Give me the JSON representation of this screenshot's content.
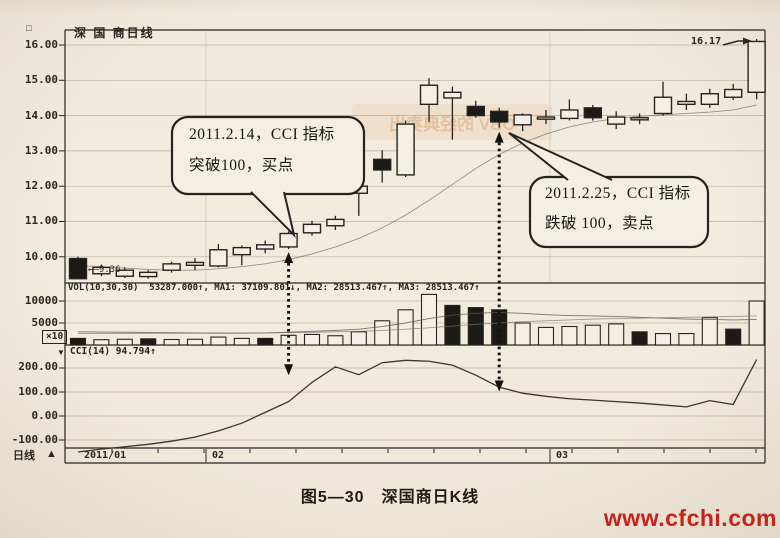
{
  "header": {
    "corner_glyph": "□",
    "title": "深 国 商日线"
  },
  "price_axis": {
    "labels": [
      "16.00",
      "15.00",
      "14.00",
      "13.00",
      "12.00",
      "11.00",
      "10.00"
    ]
  },
  "volume_axis": {
    "labels": [
      "10000",
      "5000"
    ],
    "unit": "×10"
  },
  "cci_axis": {
    "labels": [
      "200.00",
      "100.00",
      "0.00",
      "-100.00"
    ]
  },
  "indicator_labels": {
    "vol": "VOL(10,30,30)  53287.000↑, MA1: 37109.801↓, MA2: 28513.467↑, MA3: 28513.467↑",
    "cci_pointer": "▼",
    "cci": "CCI(14) 94.794↑"
  },
  "date_axis": {
    "labels": [
      "2011/01",
      "02",
      "03"
    ],
    "period": "日线",
    "marker": "▲"
  },
  "price_tags": {
    "first_low": "←–9.36",
    "last_high": "16.17"
  },
  "callouts": {
    "buy": {
      "line1": "2011.2.14，CCI 指标",
      "line2": "突破100，买点"
    },
    "sell": {
      "line1": "2011.2.25，CCI 指标",
      "line2": "跌破 100，卖点"
    }
  },
  "caption": "图5—30　深国商日K线",
  "watermark": "www.cfchi.com",
  "decor": {
    "ghost_text": "OBV 的经典卖出"
  },
  "colors": {
    "ink": "#26231f",
    "paper": "#f4efe4",
    "watermark_red": "#cf1d18"
  },
  "chart_data": {
    "type": "candlestick",
    "title": "深国商日线",
    "panels": [
      "price",
      "volume",
      "cci"
    ],
    "x_labels": [
      "2011/01",
      "02",
      "03"
    ],
    "price": {
      "ylim": [
        9.2,
        16.45
      ],
      "gridlines": [
        16,
        15,
        14,
        13,
        12,
        11,
        10
      ],
      "candles": [
        [
          9.95,
          10.0,
          9.36,
          9.38
        ],
        [
          9.52,
          9.78,
          9.45,
          9.7
        ],
        [
          9.45,
          9.7,
          9.4,
          9.62
        ],
        [
          9.44,
          9.62,
          9.38,
          9.56
        ],
        [
          9.62,
          9.86,
          9.55,
          9.8
        ],
        [
          9.76,
          9.96,
          9.62,
          9.84
        ],
        [
          9.74,
          10.36,
          9.7,
          10.2
        ],
        [
          10.06,
          10.32,
          9.76,
          10.26
        ],
        [
          10.22,
          10.46,
          10.1,
          10.34
        ],
        [
          10.28,
          10.72,
          10.22,
          10.66
        ],
        [
          10.68,
          11.02,
          10.6,
          10.92
        ],
        [
          10.88,
          11.16,
          10.76,
          11.06
        ],
        [
          11.8,
          12.06,
          11.16,
          12.0
        ],
        [
          12.76,
          13.02,
          12.1,
          12.46
        ],
        [
          12.32,
          13.86,
          12.26,
          13.76
        ],
        [
          14.32,
          15.06,
          13.82,
          14.86
        ],
        [
          14.5,
          14.82,
          13.32,
          14.66
        ],
        [
          14.26,
          14.42,
          13.94,
          14.0
        ],
        [
          14.12,
          14.22,
          13.66,
          13.82
        ],
        [
          13.74,
          14.06,
          13.56,
          14.02
        ],
        [
          13.9,
          14.16,
          13.76,
          13.96
        ],
        [
          13.92,
          14.46,
          13.86,
          14.16
        ],
        [
          14.22,
          14.3,
          13.86,
          13.94
        ],
        [
          13.76,
          14.12,
          13.62,
          13.96
        ],
        [
          13.88,
          14.06,
          13.76,
          13.94
        ],
        [
          14.06,
          14.96,
          14.0,
          14.52
        ],
        [
          14.32,
          14.62,
          14.16,
          14.4
        ],
        [
          14.32,
          14.76,
          14.22,
          14.62
        ],
        [
          14.52,
          14.9,
          14.44,
          14.74
        ],
        [
          14.66,
          16.17,
          14.46,
          16.1
        ]
      ],
      "ma": [
        9.75,
        9.72,
        9.68,
        9.64,
        9.62,
        9.62,
        9.66,
        9.72,
        9.8,
        9.92,
        10.08,
        10.28,
        10.52,
        10.82,
        11.18,
        11.6,
        12.05,
        12.5,
        12.9,
        13.22,
        13.48,
        13.68,
        13.82,
        13.92,
        13.98,
        14.02,
        14.06,
        14.1,
        14.16,
        14.3
      ]
    },
    "volume": {
      "scale_unit": "×10",
      "gridlines": [
        10000,
        5000
      ],
      "bars": [
        [
          1500,
          "b"
        ],
        [
          1200,
          "w"
        ],
        [
          1300,
          "w"
        ],
        [
          1400,
          "b"
        ],
        [
          1250,
          "w"
        ],
        [
          1300,
          "w"
        ],
        [
          1800,
          "w"
        ],
        [
          1500,
          "w"
        ],
        [
          1500,
          "b"
        ],
        [
          2200,
          "w"
        ],
        [
          2400,
          "w"
        ],
        [
          2100,
          "w"
        ],
        [
          3000,
          "w"
        ],
        [
          5500,
          "w"
        ],
        [
          8000,
          "w"
        ],
        [
          11500,
          "w"
        ],
        [
          9000,
          "b"
        ],
        [
          8500,
          "b"
        ],
        [
          8000,
          "b"
        ],
        [
          5000,
          "w"
        ],
        [
          4000,
          "w"
        ],
        [
          4200,
          "w"
        ],
        [
          4500,
          "w"
        ],
        [
          4800,
          "w"
        ],
        [
          3000,
          "b"
        ],
        [
          2600,
          "w"
        ],
        [
          2600,
          "w"
        ],
        [
          6200,
          "w"
        ],
        [
          3600,
          "b"
        ],
        [
          10000,
          "w"
        ]
      ],
      "ma_fast": [
        3000,
        2950,
        2900,
        2850,
        2800,
        2750,
        2700,
        2700,
        2750,
        2900,
        3100,
        3300,
        3600,
        4200,
        5000,
        6000,
        6800,
        7200,
        7400,
        7200,
        6900,
        6700,
        6600,
        6500,
        6300,
        6100,
        5900,
        5800,
        5700,
        5800
      ],
      "ma_slow": [
        2600,
        2600,
        2600,
        2650,
        2650,
        2700,
        2700,
        2750,
        2750,
        2800,
        2900,
        3000,
        3100,
        3300,
        3600,
        3900,
        4300,
        4700,
        5000,
        5300,
        5500,
        5700,
        5900,
        6000,
        6100,
        6200,
        6300,
        6400,
        6500,
        6600
      ]
    },
    "cci": {
      "period": 14,
      "last_value": 94.794,
      "gridlines": [
        200,
        100,
        0,
        -100
      ],
      "values": [
        -150,
        -138,
        -128,
        -118,
        -105,
        -88,
        -62,
        -30,
        15,
        60,
        140,
        205,
        172,
        222,
        232,
        228,
        212,
        170,
        120,
        95,
        82,
        72,
        66,
        60,
        54,
        46,
        38,
        64,
        48,
        235
      ]
    },
    "events": [
      {
        "index": 9,
        "type": "buy",
        "date": "2011.2.14",
        "note": "CCI 突破100，买点"
      },
      {
        "index": 18,
        "type": "sell",
        "date": "2011.2.25",
        "note": "CCI 跌破100，卖点"
      }
    ],
    "last_high_label": 16.17,
    "first_low_label": -9.36
  }
}
